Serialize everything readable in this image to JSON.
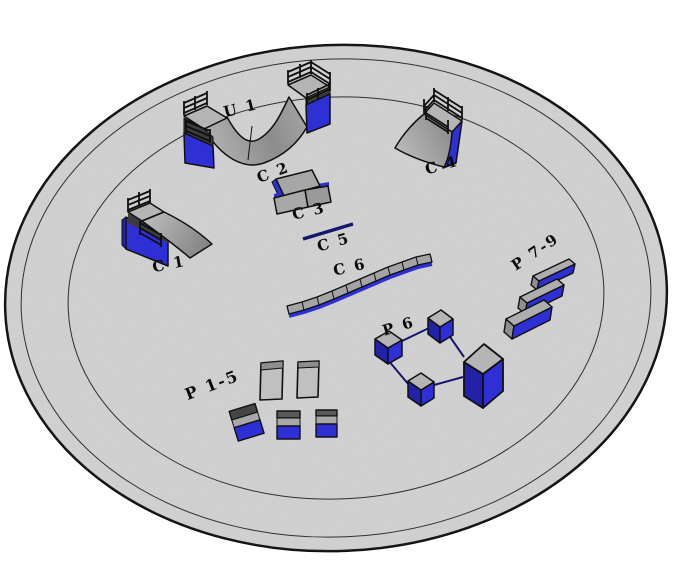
{
  "scene": {
    "labels": {
      "u1": "U 1",
      "c1": "C 1",
      "c2": "C 2",
      "c3": "C 3",
      "c4": "C 4",
      "c5": "C 5",
      "c6": "C 6",
      "p1_5": "P 1-5",
      "p6": "P 6",
      "p7_9": "P 7-9"
    },
    "colors": {
      "background": "#ffffff",
      "floor": "#d3d3d3",
      "ring_line": "#2f2f2f",
      "outline": "#101010",
      "ramp_gray": "#a0a0a0",
      "deck_gray": "#b5b5b5",
      "blue": "#2f2fd6",
      "blue_dark": "#2222a8",
      "rail_navy": "#16166e",
      "label": "#0a0a0a"
    }
  }
}
